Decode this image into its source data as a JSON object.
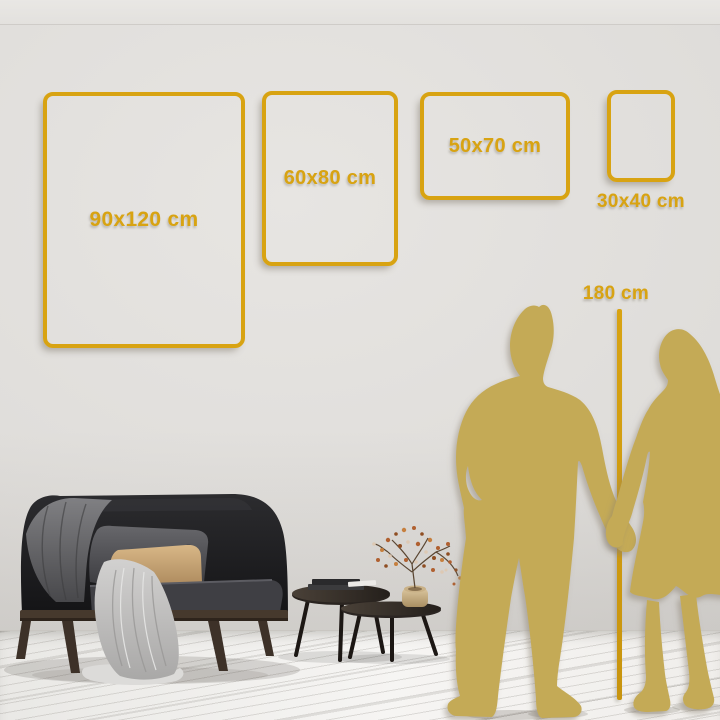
{
  "size_guide": {
    "frames": [
      {
        "label": "90x120 cm",
        "width_cm": 90,
        "height_cm": 120
      },
      {
        "label": "60x80 cm",
        "width_cm": 60,
        "height_cm": 80
      },
      {
        "label": "50x70 cm",
        "width_cm": 50,
        "height_cm": 70
      },
      {
        "label": "30x40 cm",
        "width_cm": 30,
        "height_cm": 40
      }
    ],
    "height_reference": {
      "label": "180 cm",
      "value_cm": 180
    }
  },
  "colors": {
    "gold": "#D8A312",
    "silhouette": "#C4AA56",
    "wall": "#DEDCD9",
    "floor": "#F4F3F1"
  },
  "scene": {
    "objects": [
      "dark-sofa",
      "gray-throw-blanket",
      "light-draped-blanket",
      "gray-cushion",
      "tan-cushion",
      "nesting-coffee-tables",
      "stacked-books",
      "brass-vase-dried-flowers",
      "man-silhouette",
      "woman-silhouette",
      "height-measure-line"
    ]
  }
}
